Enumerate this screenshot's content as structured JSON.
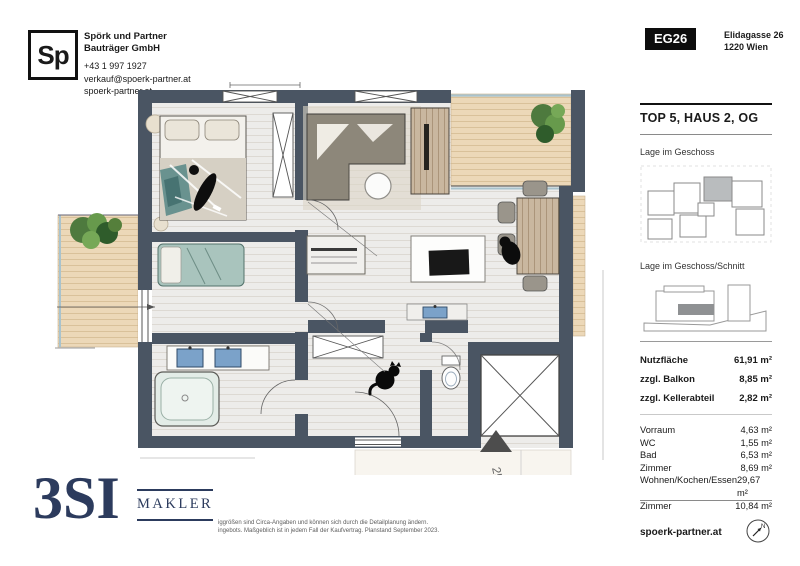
{
  "header": {
    "logo_text": "Sp",
    "company_line1": "Spörk und Partner",
    "company_line2": "Bauträger GmbH",
    "phone": "+43 1 997 1927",
    "email": "verkauf@spoerk-partner.at",
    "website": "spoerk-partner.at",
    "project_code": "EG26",
    "address_line1": "Elidagasse 26",
    "address_line2": "1220 Wien"
  },
  "sidebar": {
    "title": "TOP 5, HAUS 2, OG",
    "location_label": "Lage im Geschoss",
    "section_label": "Lage im Geschoss/Schnitt",
    "areas": [
      {
        "label": "Nutzfläche",
        "value": "61,91 m²"
      },
      {
        "label": "zzgl. Balkon",
        "value": "8,85 m²"
      },
      {
        "label": "zzgl. Kellerabteil",
        "value": "2,82 m²"
      }
    ],
    "rooms": [
      {
        "label": "Vorraum",
        "value": "4,63 m²"
      },
      {
        "label": "WC",
        "value": "1,55 m²"
      },
      {
        "label": "Bad",
        "value": "6,53 m²"
      },
      {
        "label": "Zimmer",
        "value": "8,69 m²"
      },
      {
        "label": "Wohnen/Kochen/Essen",
        "value": "29,67 m²"
      },
      {
        "label": "Zimmer",
        "value": "10,84 m²"
      }
    ],
    "website": "spoerk-partner.at"
  },
  "plan": {
    "handwritten_note": "25"
  },
  "footer": {
    "broker_logo_main": "3SI",
    "broker_logo_sub": "MAKLER",
    "disclaimer_line1": "iggrößen sind Circa-Angaben und können sich durch die Detailplanung ändern.",
    "disclaimer_line2": "ingebots. Maßgeblich ist in jedem Fall der Kaufvertrag. Planstand September 2023."
  },
  "colors": {
    "navy": "#2c3b5d",
    "wall": "#4a5563",
    "deck": "#ecd8b8",
    "teal": "#5d8b89"
  }
}
